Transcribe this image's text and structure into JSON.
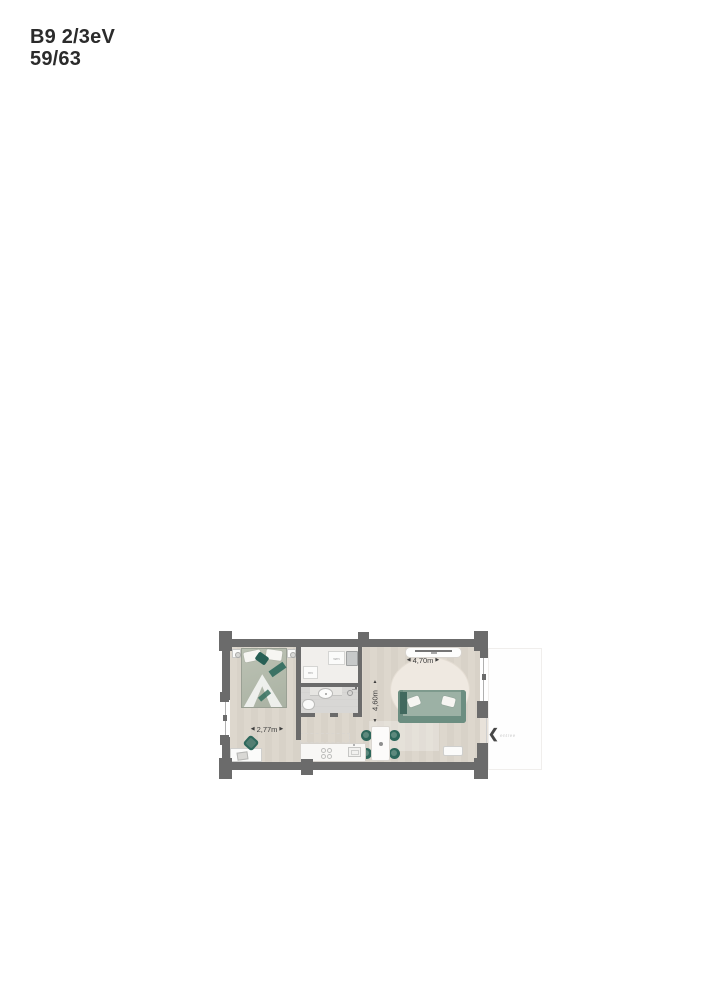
{
  "header": {
    "unit": "B9 2/3eV",
    "page": "59/63"
  },
  "plan": {
    "dimensions": {
      "bedroom_width": "2,77m",
      "living_width": "4,70m",
      "living_depth": "4,60m"
    },
    "icons": {
      "arrow_left": "◀",
      "arrow_right": "▶",
      "arrow_up": "▲",
      "arrow_down": "▼",
      "entree_arrow": "❮"
    },
    "labels": {
      "entree": "entree",
      "washing_machine": "wm",
      "ventilation": "mv"
    },
    "colors": {
      "wall": "#6b6b6b",
      "accent_teal": "#2e685c",
      "floor_wood": "#dcd6cc",
      "bathroom_floor": "#d8d7d5",
      "sofa_green": "#7e9a8d",
      "rug": "#efe9e1"
    }
  }
}
